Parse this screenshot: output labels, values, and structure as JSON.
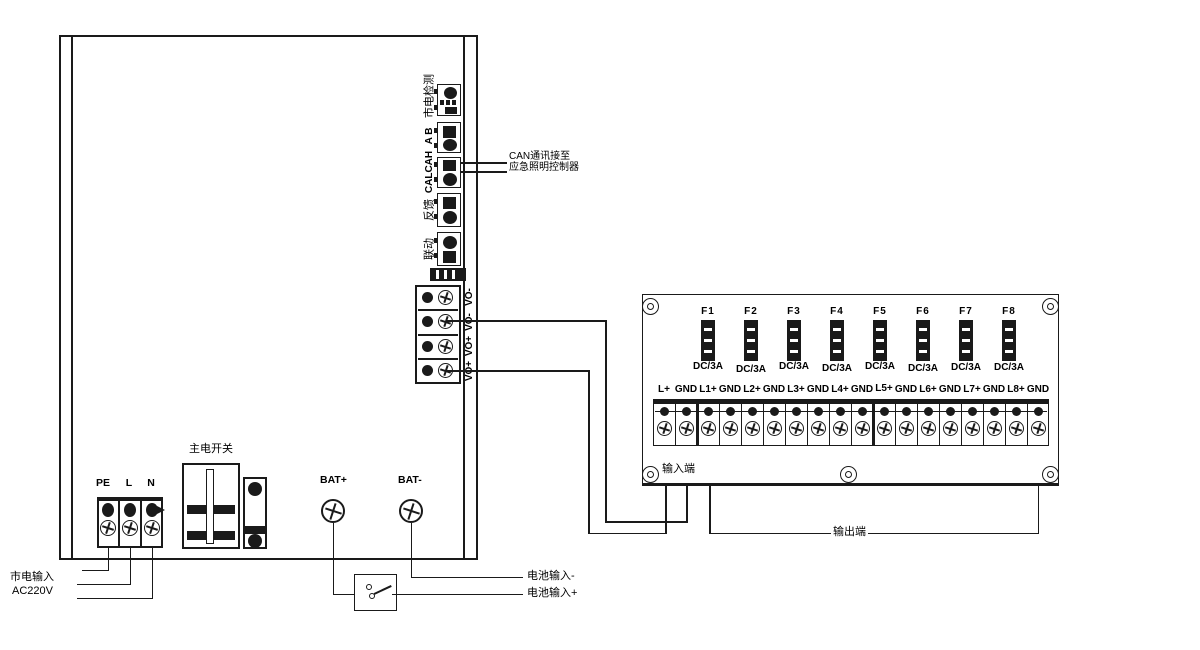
{
  "enclosure": {
    "modules": [
      {
        "label": "市电检测"
      },
      {
        "label": "A B"
      },
      {
        "label": "CALCAH"
      },
      {
        "label": "反馈"
      },
      {
        "label": "联动"
      }
    ],
    "vo_labels": [
      "VO-",
      "VO-",
      "VO+",
      "VO+"
    ],
    "mains_terminals": [
      "PE",
      "L",
      "N"
    ],
    "main_switch_label": "主电开关",
    "bat_plus_label": "BAT+",
    "bat_minus_label": "BAT-"
  },
  "annotations": {
    "can_line1": "CAN通讯接至",
    "can_line2": "应急照明控制器",
    "mains_input": "市电输入",
    "mains_voltage": "AC220V",
    "battery_in_minus": "电池输入-",
    "battery_in_plus": "电池输入+",
    "output_side": "输出端"
  },
  "fuse_panel": {
    "input_side_label": "输入端",
    "fuses": [
      {
        "name": "F1",
        "rating": "DC/3A"
      },
      {
        "name": "F2",
        "rating": "DC/3A"
      },
      {
        "name": "F3",
        "rating": "DC/3A"
      },
      {
        "name": "F4",
        "rating": "DC/3A"
      },
      {
        "name": "F5",
        "rating": "DC/3A"
      },
      {
        "name": "F6",
        "rating": "DC/3A"
      },
      {
        "name": "F7",
        "rating": "DC/3A"
      },
      {
        "name": "F8",
        "rating": "DC/3A"
      }
    ],
    "terminals": [
      "L+",
      "GND",
      "L1+",
      "GND",
      "L2+",
      "GND",
      "L3+",
      "GND",
      "L4+",
      "GND",
      "L5+",
      "GND",
      "L6+",
      "GND",
      "L7+",
      "GND",
      "L8+",
      "GND"
    ]
  },
  "colors": {
    "line": "#1a1a1a",
    "background": "#ffffff"
  }
}
